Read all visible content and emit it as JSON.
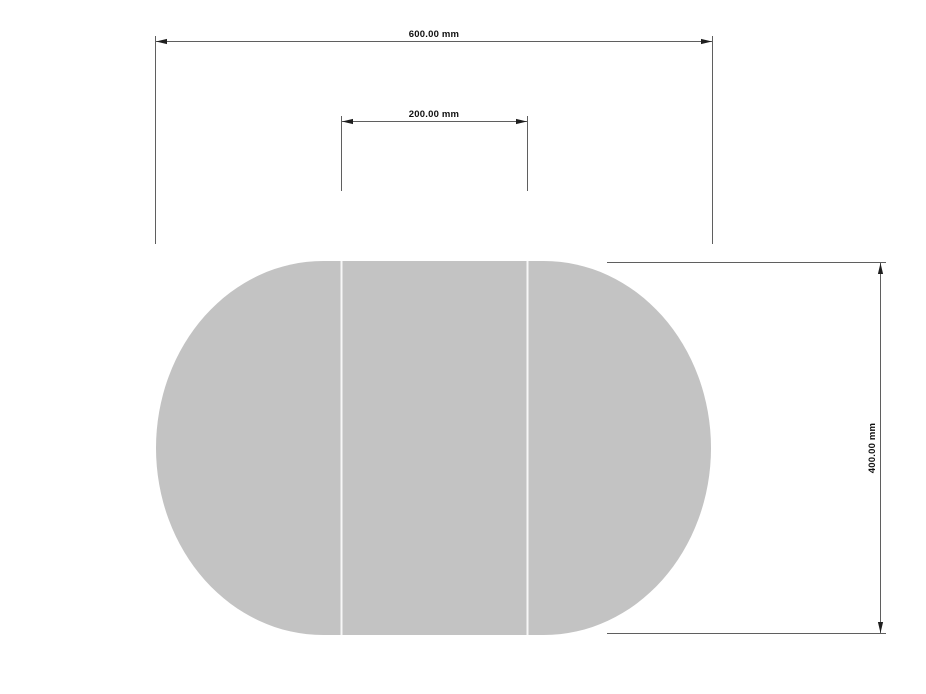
{
  "colors": {
    "background": "#ffffff",
    "shape_fill": "#c3c3c3",
    "divider_line": "#f7f7f7",
    "line": "#5f5f5f",
    "arrow": "#1f1f1f",
    "label_text": "#101010"
  },
  "drawing": {
    "dimensions": {
      "overall_width": {
        "label": "600.00 mm",
        "value": 600.0,
        "unit": "mm",
        "orientation": "horizontal"
      },
      "leaf_width": {
        "label": "200.00 mm",
        "value": 200.0,
        "unit": "mm",
        "orientation": "horizontal"
      },
      "overall_depth": {
        "label": "400.00 mm",
        "value": 400.0,
        "unit": "mm",
        "orientation": "vertical"
      }
    },
    "shape": {
      "sections": 3
    }
  }
}
